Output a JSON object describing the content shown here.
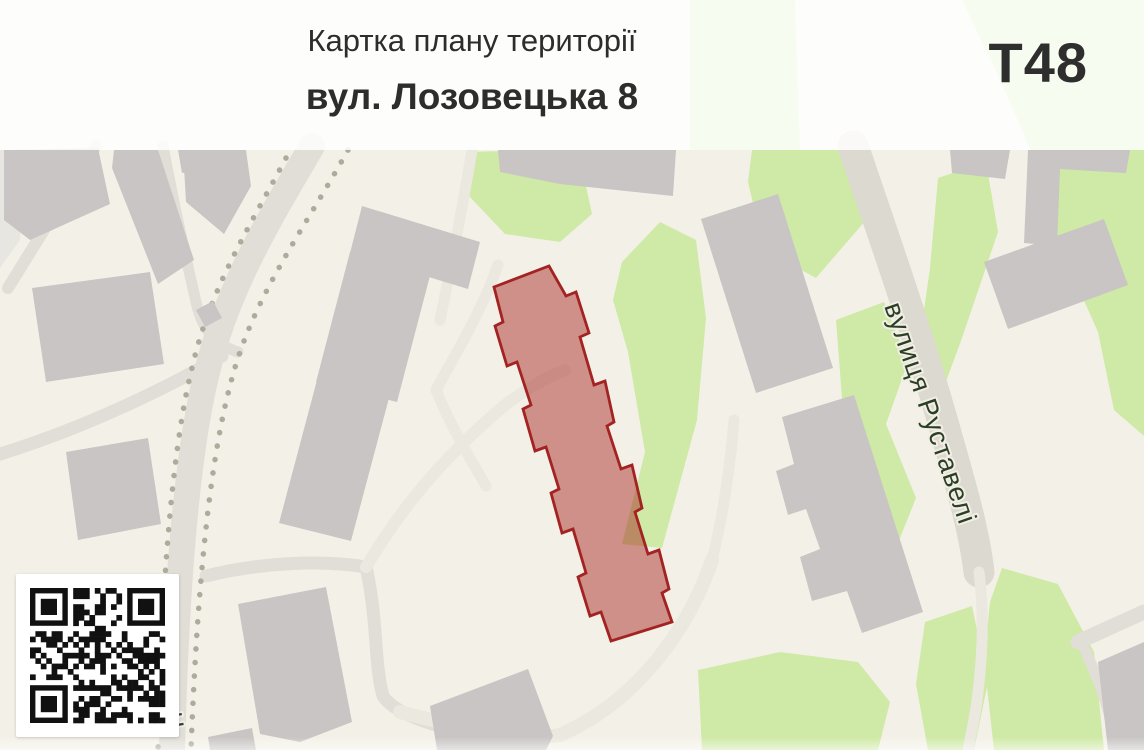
{
  "header": {
    "title": "Картка плану території",
    "subtitle": "вул. Лозовецька 8",
    "code": "Т48"
  },
  "map": {
    "street_label": "вулиця Руставелі",
    "street_label_partial": "Ч",
    "highlight": {
      "label": "вул. Лозовецька 8",
      "points": [
        [
          494,
          287
        ],
        [
          549,
          266
        ],
        [
          566,
          296
        ],
        [
          576,
          292
        ],
        [
          589,
          333
        ],
        [
          580,
          337
        ],
        [
          594,
          385
        ],
        [
          605,
          381
        ],
        [
          614,
          422
        ],
        [
          607,
          426
        ],
        [
          621,
          469
        ],
        [
          632,
          465
        ],
        [
          642,
          508
        ],
        [
          635,
          512
        ],
        [
          648,
          554
        ],
        [
          659,
          550
        ],
        [
          669,
          589
        ],
        [
          662,
          593
        ],
        [
          672,
          622
        ],
        [
          611,
          641
        ],
        [
          601,
          612
        ],
        [
          590,
          616
        ],
        [
          578,
          577
        ],
        [
          586,
          573
        ],
        [
          573,
          529
        ],
        [
          562,
          533
        ],
        [
          551,
          493
        ],
        [
          559,
          489
        ],
        [
          546,
          447
        ],
        [
          535,
          451
        ],
        [
          523,
          409
        ],
        [
          531,
          405
        ],
        [
          517,
          362
        ],
        [
          507,
          366
        ],
        [
          495,
          326
        ],
        [
          503,
          322
        ]
      ]
    },
    "colors": {
      "bg": "#f3f1e7",
      "bg_shade": "#e8e6e0",
      "green": "#cfe9a6",
      "building": "#c8c5c4",
      "road": "#e0ded6",
      "road_major": "#dcd9d1",
      "road_pale": "#eae8df",
      "tree": "#adab9b",
      "hl_fill": "rgba(166,38,34,0.48)",
      "hl_stroke": "#a32222"
    },
    "pale_patches": [
      [
        [
          0,
          150
        ],
        [
          26,
          150
        ],
        [
          20,
          240
        ],
        [
          0,
          268
        ]
      ]
    ],
    "greens": [
      [
        [
          468,
          152
        ],
        [
          545,
          150
        ],
        [
          583,
          172
        ],
        [
          592,
          214
        ],
        [
          560,
          242
        ],
        [
          505,
          234
        ],
        [
          469,
          196
        ]
      ],
      [
        [
          622,
          262
        ],
        [
          660,
          222
        ],
        [
          696,
          240
        ],
        [
          706,
          318
        ],
        [
          697,
          420
        ],
        [
          662,
          548
        ],
        [
          622,
          544
        ],
        [
          645,
          452
        ],
        [
          628,
          352
        ],
        [
          613,
          300
        ]
      ],
      [
        [
          690,
          0
        ],
        [
          795,
          0
        ],
        [
          800,
          150
        ],
        [
          690,
          150
        ]
      ],
      [
        [
          752,
          150
        ],
        [
          868,
          150
        ],
        [
          866,
          220
        ],
        [
          816,
          278
        ],
        [
          764,
          250
        ],
        [
          748,
          182
        ]
      ],
      [
        [
          836,
          320
        ],
        [
          884,
          302
        ],
        [
          908,
          362
        ],
        [
          886,
          424
        ],
        [
          916,
          498
        ],
        [
          892,
          558
        ],
        [
          846,
          540
        ],
        [
          818,
          472
        ],
        [
          842,
          398
        ]
      ],
      [
        [
          938,
          178
        ],
        [
          986,
          162
        ],
        [
          998,
          232
        ],
        [
          962,
          338
        ],
        [
          940,
          398
        ],
        [
          916,
          366
        ],
        [
          930,
          268
        ]
      ],
      [
        [
          962,
          0
        ],
        [
          1144,
          0
        ],
        [
          1144,
          436
        ],
        [
          1114,
          410
        ],
        [
          1098,
          332
        ],
        [
          1056,
          238
        ],
        [
          1034,
          158
        ],
        [
          1002,
          84
        ]
      ],
      [
        [
          925,
          622
        ],
        [
          972,
          606
        ],
        [
          988,
          682
        ],
        [
          974,
          750
        ],
        [
          928,
          750
        ],
        [
          916,
          684
        ]
      ],
      [
        [
          1002,
          568
        ],
        [
          1058,
          584
        ],
        [
          1094,
          652
        ],
        [
          1104,
          750
        ],
        [
          994,
          750
        ],
        [
          984,
          660
        ],
        [
          990,
          602
        ]
      ],
      [
        [
          698,
          670
        ],
        [
          780,
          652
        ],
        [
          858,
          662
        ],
        [
          890,
          702
        ],
        [
          878,
          750
        ],
        [
          702,
          750
        ]
      ]
    ],
    "roads": [
      {
        "d": "M 312,146 C 272,215 228,285 207,372 C 190,440 177,555 172,750",
        "w": 26,
        "c": "road"
      },
      {
        "d": "M 96,146 L 8,288",
        "w": 12,
        "c": "road"
      },
      {
        "d": "M 163,146 C 176,215 186,258 196,302 C 202,330 216,345 238,352",
        "w": 11,
        "c": "road"
      },
      {
        "d": "M 222,356 C 160,392 78,430 0,454",
        "w": 13,
        "c": "road"
      },
      {
        "d": "M 206,576 C 262,562 322,560 366,567",
        "w": 13,
        "c": "road"
      },
      {
        "d": "M 366,567 C 378,620 374,664 383,696 C 398,719 456,733 526,743",
        "w": 13,
        "c": "road"
      },
      {
        "d": "M 366,567 C 400,510 440,460 505,405 C 525,390 545,378 565,370",
        "w": 12,
        "c": "road_pale"
      },
      {
        "d": "M 400,712 C 470,730 520,742 560,735 C 640,700 690,625 712,560",
        "w": 14,
        "c": "road_pale"
      },
      {
        "d": "M 712,560 C 722,520 730,470 734,420",
        "w": 11,
        "c": "road_pale"
      },
      {
        "d": "M 498,265 C 482,310 458,350 436,390",
        "w": 11,
        "c": "road_pale"
      },
      {
        "d": "M 436,390 C 450,425 468,455 486,486",
        "w": 11,
        "c": "road_pale"
      },
      {
        "d": "M 472,150 C 462,210 452,262 440,320",
        "w": 11,
        "c": "road_pale"
      },
      {
        "d": "M 853,146 C 885,240 920,340 948,440 C 962,490 974,530 979,572",
        "w": 31,
        "c": "road_major"
      },
      {
        "d": "M 979,572 C 985,620 982,665 976,708 C 973,725 970,740 968,750",
        "w": 11,
        "c": "road_pale"
      },
      {
        "d": "M 1078,642 L 1144,612",
        "w": 15,
        "c": "road"
      },
      {
        "d": "M 1085,650 C 1102,688 1112,716 1116,750",
        "w": 11,
        "c": "road"
      }
    ],
    "tree_lines": [
      {
        "d": "M 348,150 C 305,228 252,298 231,382 C 213,448 198,562 191,750"
      },
      {
        "d": "M 286,158 C 250,226 210,288 192,368 C 176,432 162,552 158,750"
      }
    ],
    "buildings": [
      [
        [
          4,
          150
        ],
        [
          98,
          148
        ],
        [
          110,
          204
        ],
        [
          30,
          240
        ],
        [
          4,
          220
        ]
      ],
      [
        [
          114,
          150
        ],
        [
          158,
          150
        ],
        [
          194,
          260
        ],
        [
          158,
          284
        ],
        [
          112,
          168
        ]
      ],
      [
        [
          178,
          150
        ],
        [
          228,
          150
        ],
        [
          233,
          169
        ],
        [
          182,
          173
        ]
      ],
      [
        [
          32,
          288
        ],
        [
          150,
          272
        ],
        [
          164,
          364
        ],
        [
          46,
          382
        ]
      ],
      [
        [
          66,
          452
        ],
        [
          148,
          438
        ],
        [
          161,
          524
        ],
        [
          78,
          540
        ]
      ],
      [
        [
          196,
          310
        ],
        [
          213,
          301
        ],
        [
          222,
          318
        ],
        [
          205,
          327
        ]
      ],
      [
        [
          498,
          150
        ],
        [
          676,
          150
        ],
        [
          673,
          196
        ],
        [
          560,
          184
        ],
        [
          500,
          172
        ]
      ],
      [
        [
          183,
          150
        ],
        [
          246,
          150
        ],
        [
          251,
          186
        ],
        [
          224,
          234
        ],
        [
          186,
          202
        ]
      ],
      [
        [
          362,
          206
        ],
        [
          480,
          242
        ],
        [
          468,
          289
        ],
        [
          350,
          253
        ]
      ],
      [
        [
          350,
          252
        ],
        [
          431,
          272
        ],
        [
          397,
          402
        ],
        [
          316,
          382
        ]
      ],
      [
        [
          317,
          380
        ],
        [
          389,
          398
        ],
        [
          351,
          541
        ],
        [
          279,
          523
        ]
      ],
      [
        [
          238,
          604
        ],
        [
          326,
          587
        ],
        [
          352,
          722
        ],
        [
          300,
          742
        ],
        [
          260,
          734
        ]
      ],
      [
        [
          430,
          706
        ],
        [
          528,
          669
        ],
        [
          553,
          736
        ],
        [
          546,
          750
        ],
        [
          437,
          750
        ]
      ],
      [
        [
          701,
          219
        ],
        [
          778,
          194
        ],
        [
          833,
          368
        ],
        [
          756,
          393
        ]
      ],
      [
        [
          782,
          417
        ],
        [
          854,
          395
        ],
        [
          923,
          612
        ],
        [
          862,
          633
        ],
        [
          847,
          591
        ],
        [
          812,
          601
        ],
        [
          800,
          557
        ],
        [
          820,
          549
        ],
        [
          806,
          509
        ],
        [
          788,
          515
        ],
        [
          776,
          471
        ],
        [
          794,
          464
        ]
      ],
      [
        [
          984,
          262
        ],
        [
          1104,
          219
        ],
        [
          1128,
          285
        ],
        [
          1008,
          329
        ]
      ],
      [
        [
          1028,
          150
        ],
        [
          1130,
          150
        ],
        [
          1126,
          173
        ],
        [
          1060,
          169
        ],
        [
          1057,
          246
        ],
        [
          1024,
          243
        ]
      ],
      [
        [
          950,
          150
        ],
        [
          1010,
          150
        ],
        [
          1005,
          179
        ],
        [
          952,
          173
        ]
      ],
      [
        [
          1098,
          662
        ],
        [
          1144,
          642
        ],
        [
          1144,
          750
        ],
        [
          1108,
          750
        ]
      ],
      [
        [
          208,
          737
        ],
        [
          252,
          728
        ],
        [
          256,
          750
        ],
        [
          210,
          750
        ]
      ]
    ],
    "qr": {
      "modules": 25,
      "seed": 87,
      "fill_ratio": 0.46
    }
  }
}
